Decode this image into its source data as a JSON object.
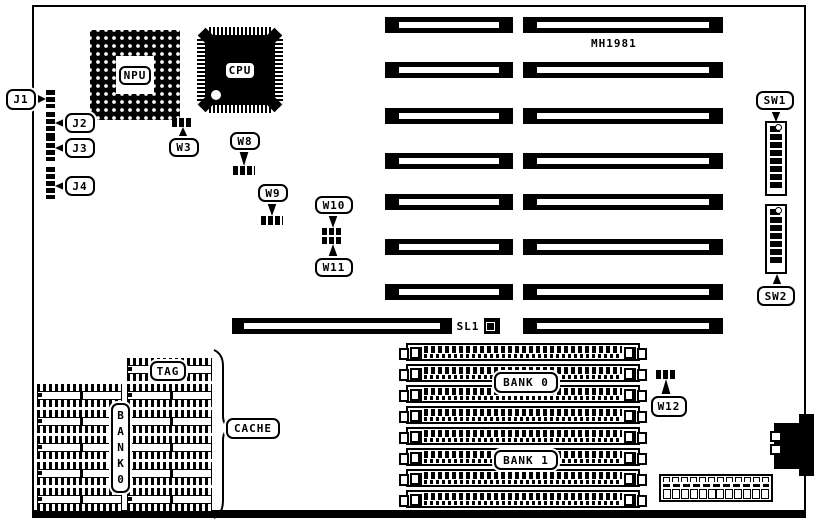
{
  "board": {
    "model": "MH1981"
  },
  "chips": {
    "npu": "NPU",
    "cpu": "CPU"
  },
  "jumpers": {
    "j1": "J1",
    "j2": "J2",
    "j3": "J3",
    "j4": "J4",
    "w3": "W3",
    "w8": "W8",
    "w9": "W9",
    "w10": "W10",
    "w11": "W11",
    "w12": "W12"
  },
  "switches": {
    "sw1": "SW1",
    "sw2": "SW2"
  },
  "slots": {
    "sl1": "SL1"
  },
  "memory": {
    "bank0": "BANK 0",
    "bank1": "BANK 1"
  },
  "cache": {
    "tag": "TAG",
    "label": "CACHE",
    "bank_vertical": "BANK0"
  },
  "colors": {
    "ink": "#000000",
    "paper": "#ffffff"
  }
}
